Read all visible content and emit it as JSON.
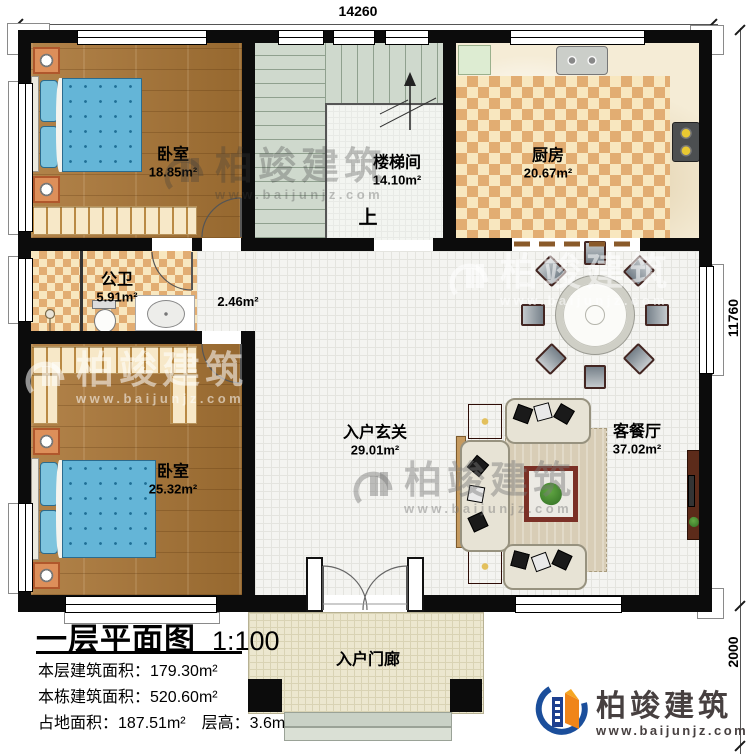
{
  "plan": {
    "dimensions": {
      "top": "14260",
      "right": "11760",
      "porch": "2000"
    },
    "rooms": {
      "bedroom1": {
        "name": "卧室",
        "area": "18.85m²"
      },
      "stairwell": {
        "name": "楼梯间",
        "area": "14.10m²",
        "up_label": "上"
      },
      "kitchen": {
        "name": "厨房",
        "area": "20.67m²"
      },
      "bathroom": {
        "name": "公卫",
        "area": "5.91m²"
      },
      "corridor": {
        "area": "2.46m²"
      },
      "bedroom2": {
        "name": "卧室",
        "area": "25.32m²"
      },
      "entry_hall": {
        "name": "入户玄关",
        "area": "29.01m²"
      },
      "living_dining": {
        "name": "客餐厅",
        "area": "37.02m²"
      },
      "porch": {
        "name": "入户门廊"
      }
    }
  },
  "title_block": {
    "title": "一层平面图",
    "scale": "1:100",
    "stats": [
      "本层建筑面积：179.30m²",
      "本栋建筑面积：520.60m²",
      "占地面积：187.51m²　层高：3.6m"
    ]
  },
  "branding": {
    "name": "柏竣建筑",
    "website": "www.baijunjz.com"
  },
  "watermark": {
    "name": "柏竣建筑",
    "website": "www.baijunjz.com"
  },
  "colors": {
    "wall": "#0c0c0c",
    "wood_floor": "#a87a42",
    "checker_tile": "#e2ad72",
    "stair_floor": "#cfd9cd",
    "hall_tile": "#f4f4f1",
    "porch_tile": "#ece7cf",
    "brand_blue": "#1b4e9b",
    "brand_orange": "#f08519"
  }
}
